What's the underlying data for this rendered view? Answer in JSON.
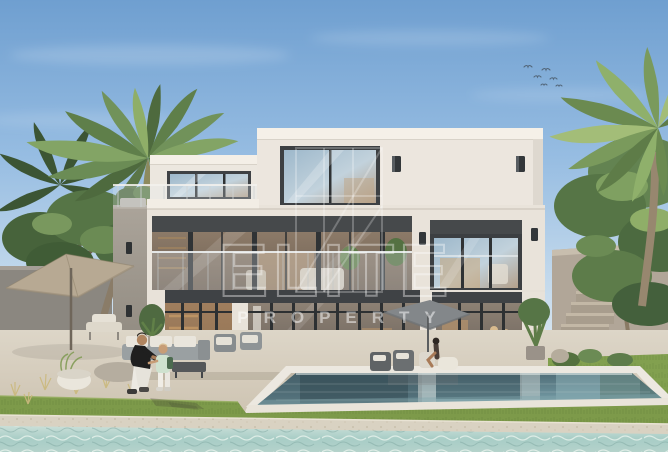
{
  "watermark": {
    "line1": "ELITE",
    "line2": "PROPERTY",
    "logo": "elite-property-monogram",
    "color": "#ffffff"
  },
  "scene": {
    "subject": "modern three-storey white villa with glass balconies, swimming pool and lagoon waterfront",
    "people": [
      "man crouching with toddler on pool deck",
      "woman seated under parasol at pool edge"
    ],
    "vegetation": [
      "palm tree left",
      "palm tree right",
      "garden shrubs",
      "frangipani tree",
      "lawn strips"
    ],
    "sky": {
      "condition": "clear with thin clouds",
      "birds_count": 6
    }
  },
  "palette": {
    "sky_top": "#6f9fd0",
    "sky_horizon": "#e4ecf2",
    "villa_wall": "#ebe5dd",
    "window_frame": "#3c3f42",
    "fascia_band": "#45484b",
    "pool_water": "#4d6f79",
    "lagoon_water": "#a8cdc6",
    "grass": "#7d9a4a",
    "deck": "#d7cfc0",
    "palm_green": "#5d7d49",
    "umbrella_beige": "#b7a993",
    "umbrella_gray": "#83878a"
  }
}
